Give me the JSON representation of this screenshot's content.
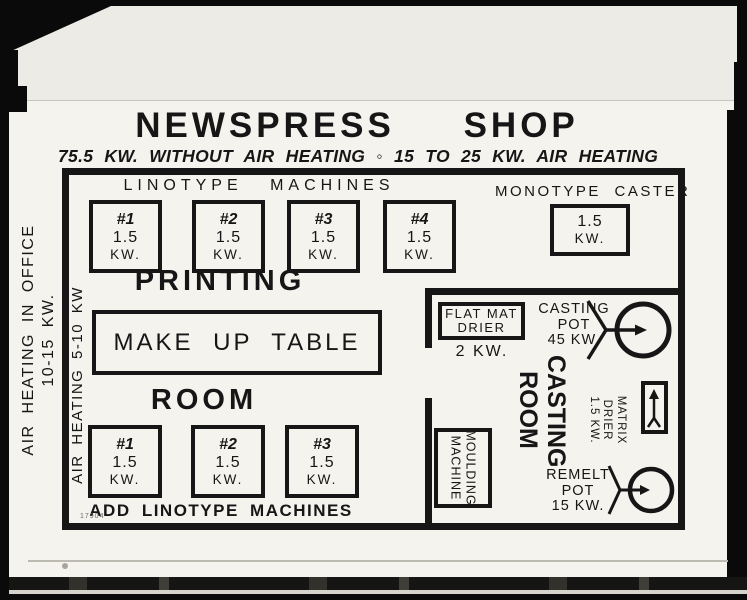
{
  "colors": {
    "ink": "#161616",
    "paper": "#f5f3ee",
    "photo_black": "#0a0a0a"
  },
  "title": "NEWSPRESS SHOP",
  "subtitle": "75.5 KW. WITHOUT AIR HEATING ◦ 15 TO 25 KW. AIR HEATING",
  "margin": {
    "office_line1": "AIR HEATING IN OFFICE",
    "office_line2": "10-15 KW.",
    "inner": "AIR HEATING 5-10 KW"
  },
  "linotype": {
    "label": "LINOTYPE MACHINES",
    "machines": [
      {
        "num": "#1",
        "kw": "1.5",
        "unit": "KW."
      },
      {
        "num": "#2",
        "kw": "1.5",
        "unit": "KW."
      },
      {
        "num": "#3",
        "kw": "1.5",
        "unit": "KW."
      },
      {
        "num": "#4",
        "kw": "1.5",
        "unit": "KW."
      }
    ]
  },
  "monotype": {
    "label": "MONOTYPE CASTER",
    "kw": "1.5",
    "unit": "KW."
  },
  "printing": {
    "word1": "PRINTING",
    "word2": "ROOM",
    "table": "MAKE UP TABLE",
    "add_label": "ADD LINOTYPE MACHINES",
    "machines": [
      {
        "num": "#1",
        "kw": "1.5",
        "unit": "KW."
      },
      {
        "num": "#2",
        "kw": "1.5",
        "unit": "KW."
      },
      {
        "num": "#3",
        "kw": "1.5",
        "unit": "KW."
      }
    ]
  },
  "casting": {
    "name_line1": "CASTING",
    "name_line2": "ROOM",
    "flat_mat": {
      "line1": "FLAT MAT",
      "line2": "DRIER",
      "kw": "2 KW."
    },
    "pot": {
      "line1": "CASTING",
      "line2": "POT",
      "line3": "45 KW."
    },
    "matrix": {
      "line1": "MATRIX",
      "line2": "DRIER",
      "line3": "1.5 KW."
    },
    "moulding": {
      "line1": "MOULDING",
      "line2": "MACHINE"
    },
    "remelt": {
      "line1": "REMELT",
      "line2": "POT",
      "line3": "15 KW."
    }
  },
  "stamp": "17904"
}
